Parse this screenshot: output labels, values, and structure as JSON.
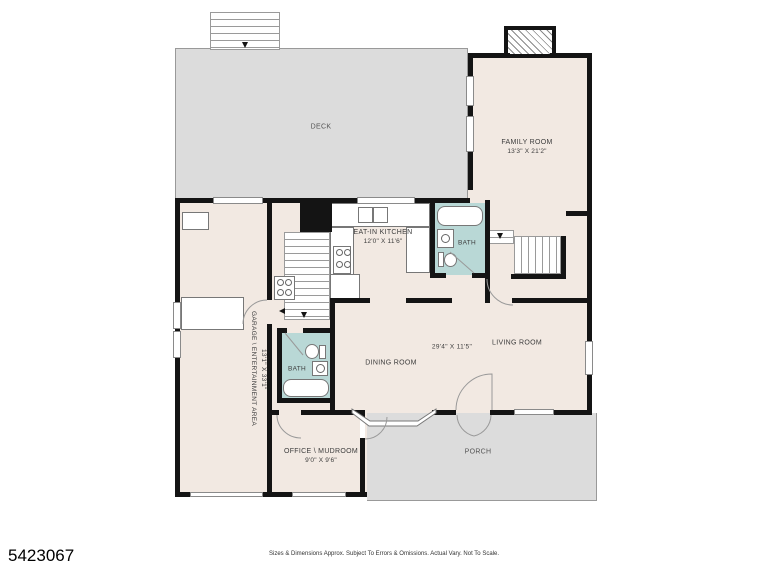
{
  "footer": {
    "listing_id": "5423067",
    "disclaimer": "Sizes & Dimensions Approx. Subject To Errors & Omissions. Actual Vary. Not To Scale."
  },
  "colors": {
    "room_fill": "#f2e9e2",
    "outdoor_fill": "#dcdcdc",
    "bath_fill": "#b9d8d6",
    "wall": "#141414"
  },
  "rooms": {
    "deck": {
      "label": "DECK"
    },
    "family_room": {
      "label": "FAMILY ROOM",
      "dims": "13'3\" X 21'2\""
    },
    "kitchen": {
      "label": "EAT-IN KITCHEN",
      "dims": "12'0\" X 11'6\""
    },
    "bath_upper": {
      "label": "BATH"
    },
    "bath_lower": {
      "label": "BATH"
    },
    "garage": {
      "label": "GARAGE \\ ENTERTAINMENT AREA",
      "dims": "13'1\" X 33'1\""
    },
    "dining_room": {
      "label": "DINING ROOM"
    },
    "living_room": {
      "label": "LIVING ROOM"
    },
    "living_dining_dims": "29'4\" X 11'5\"",
    "office": {
      "label": "OFFICE \\ MUDROOM",
      "dims": "9'0\" X 9'6\""
    },
    "porch": {
      "label": "PORCH"
    }
  }
}
